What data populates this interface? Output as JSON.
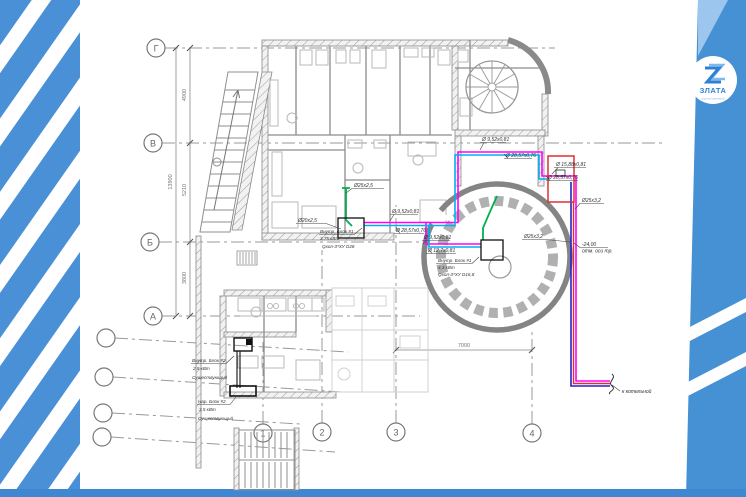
{
  "logo": {
    "monogram": "Z",
    "name": "ЗЛАТА",
    "tagline": "группа компаний"
  },
  "axes": {
    "rows": [
      {
        "label": "Г"
      },
      {
        "label": "В"
      },
      {
        "label": "Б"
      },
      {
        "label": "А"
      }
    ],
    "cols": [
      {
        "label": "1"
      },
      {
        "label": "2"
      },
      {
        "label": "3"
      },
      {
        "label": "4"
      }
    ]
  },
  "dimensions": {
    "overall": "13900",
    "seg_g_v": "4900",
    "seg_v_b": "5210",
    "seg_b_a": "3800",
    "span_3_4": "7000"
  },
  "units": {
    "unit_kitchen": {
      "title": "Внутр. Блок #1",
      "power": "3,75 кВт",
      "spec": "Qхол-3*ХУ D28"
    },
    "unit_hall": {
      "title": "Внутр. Блок #1",
      "power": "4,3 кВт",
      "spec": "Qхол-3*ХУ D16,8"
    },
    "unit_indoor2": {
      "title": "Внутр. Блок #2",
      "power": "2,5 кВт",
      "status": "Существующий"
    },
    "unit_outdoor2": {
      "title": "Нар. Блок #2",
      "power": "3,5 кВт",
      "status": "Существующий"
    }
  },
  "pipe_labels": {
    "green_riser": "Ø25x2,5",
    "green_branch": "Ø20x2,5",
    "pair_mid_upper": "Ø 9,52x0,81",
    "pair_mid_lower": "Ø 28,57x0,76",
    "hall_upper": "Ø 9,52x0,81",
    "hall_lower": "Ø 12,7x0,81",
    "top_upper": "Ø 9,52x0,81",
    "top_lower": "Ø 28,57x0,76",
    "box_upper": "Ø 15,88x0,81",
    "box_lower": "Ø 28,57x0,76",
    "main_riser_1": "Ø25x3,2",
    "main_riser_2": "Ø25x3,2"
  },
  "notes": {
    "elevation": "-24,00",
    "elevation_note": "отм. оси тр.",
    "to_boiler": "к котельной"
  },
  "colors": {
    "accent_blue": "#4a90d6",
    "pipe_green": "#00b050",
    "pipe_magenta": "#ff00ff",
    "pipe_cyan": "#00b0f0",
    "pipe_blue": "#2222cc",
    "pipe_red": "#e03030"
  }
}
